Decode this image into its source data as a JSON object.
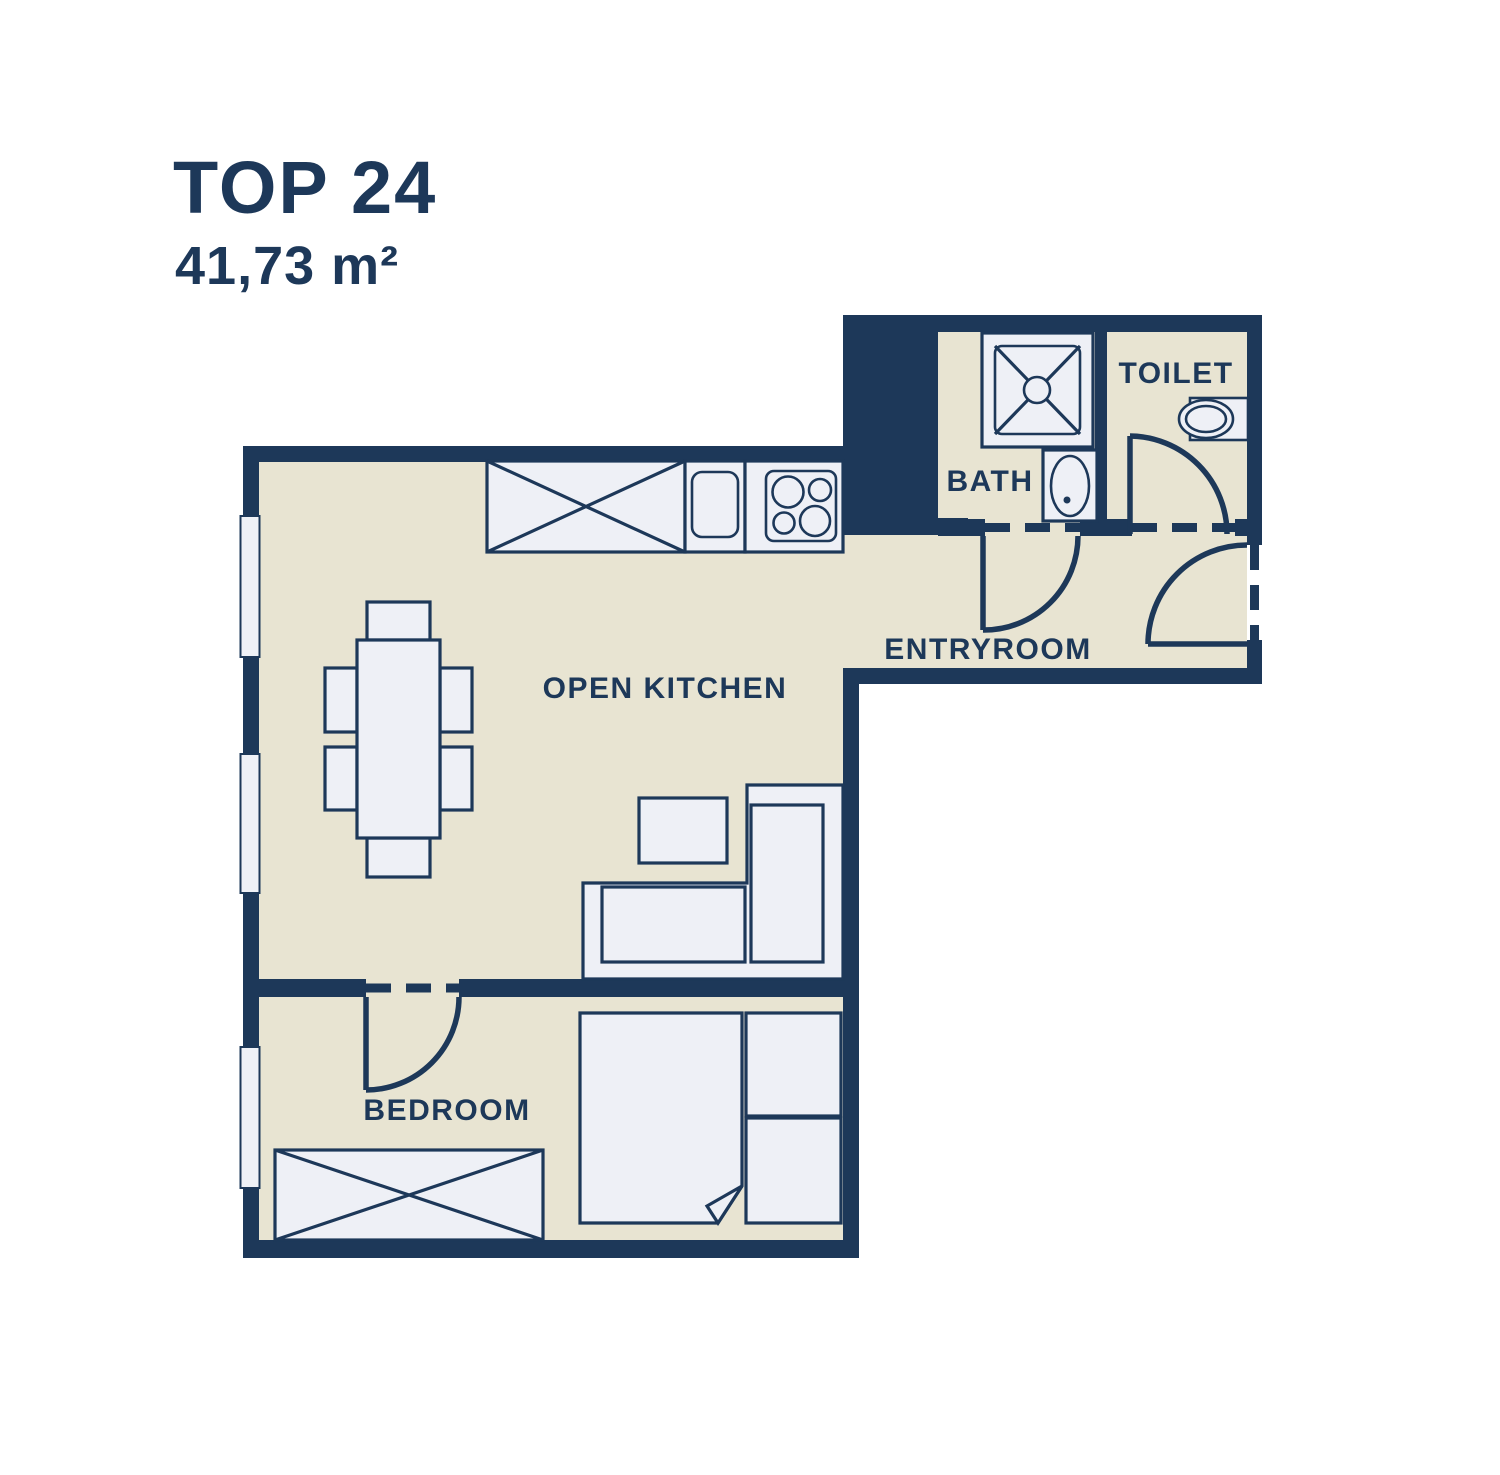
{
  "header": {
    "unit": "TOP 24",
    "area": "41,73 m²"
  },
  "rooms": [
    {
      "id": "open-kitchen",
      "label": "OPEN KITCHEN"
    },
    {
      "id": "bedroom",
      "label": "BEDROOM"
    },
    {
      "id": "bath",
      "label": "BATH"
    },
    {
      "id": "toilet",
      "label": "TOILET"
    },
    {
      "id": "entryroom",
      "label": "ENTRYROOM"
    }
  ],
  "furniture": [
    "kitchen-counter",
    "kitchen-sink",
    "stove",
    "dining-table",
    "chairs",
    "coffee-table",
    "corner-sofa",
    "double-bed",
    "wardrobe",
    "shower",
    "washbasin",
    "toilet-bowl"
  ],
  "doors": [
    "bedroom-door",
    "bath-door",
    "toilet-door",
    "entry-door"
  ],
  "windows_count": 3,
  "colors": {
    "wall": "#1d3859",
    "floor": "#e8e4d2",
    "furniture": "#eef0f6",
    "window": "#eff1f7",
    "background": "#ffffff"
  }
}
